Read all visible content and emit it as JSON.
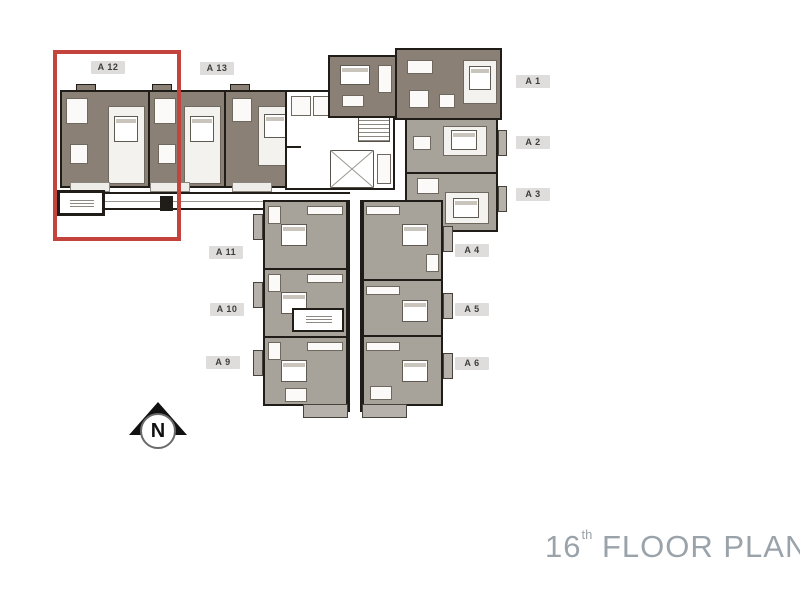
{
  "page_title": "16th Floor Plan",
  "floor_plan": {
    "title": {
      "number": "16",
      "suffix": "th",
      "label": "FLOOR PLAN"
    },
    "compass": {
      "label": "N"
    },
    "highlighted_unit": "A 12",
    "units": [
      {
        "id": "A12",
        "label": "A 12",
        "highlighted": true
      },
      {
        "id": "A13",
        "label": "A 13",
        "highlighted": false
      },
      {
        "id": "A1",
        "label": "A 1",
        "highlighted": false
      },
      {
        "id": "A2",
        "label": "A 2",
        "highlighted": false
      },
      {
        "id": "A3",
        "label": "A 3",
        "highlighted": false
      },
      {
        "id": "A11",
        "label": "A 11",
        "highlighted": false
      },
      {
        "id": "A10",
        "label": "A 10",
        "highlighted": false
      },
      {
        "id": "A9",
        "label": "A 9",
        "highlighted": false
      },
      {
        "id": "A4",
        "label": "A 4",
        "highlighted": false
      },
      {
        "id": "A5",
        "label": "A 5",
        "highlighted": false
      },
      {
        "id": "A6",
        "label": "A 6",
        "highlighted": false
      }
    ],
    "colors": {
      "highlight_red": "#c5433d",
      "unit_fill_dark": "#8a8076",
      "unit_fill_light": "#a7a29a",
      "wall": "#201d19",
      "label_bg": "#dedddb",
      "label_text": "#3d3d3b",
      "title_text": "#9aa3aa"
    }
  }
}
